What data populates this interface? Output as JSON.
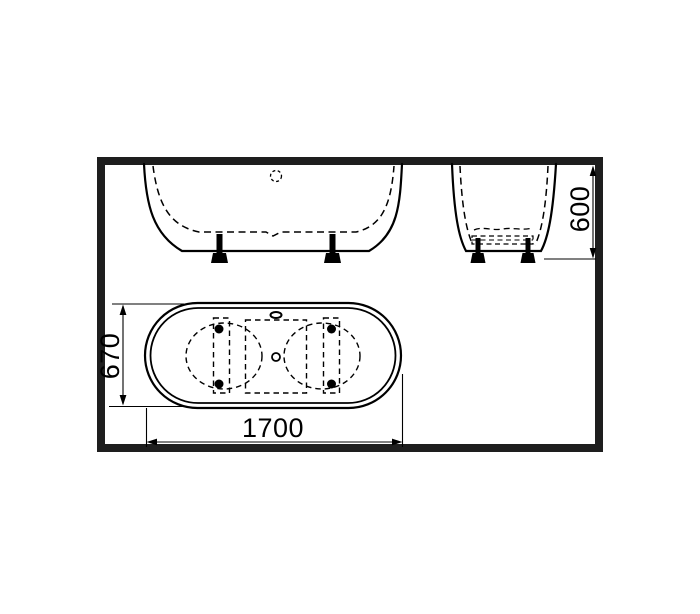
{
  "diagram": {
    "dimension_labels": {
      "length": "1700",
      "width": "670",
      "height": "600"
    },
    "colors": {
      "line": "#000000",
      "frame_border": "#1e1e1e",
      "background": "#ffffff"
    }
  }
}
